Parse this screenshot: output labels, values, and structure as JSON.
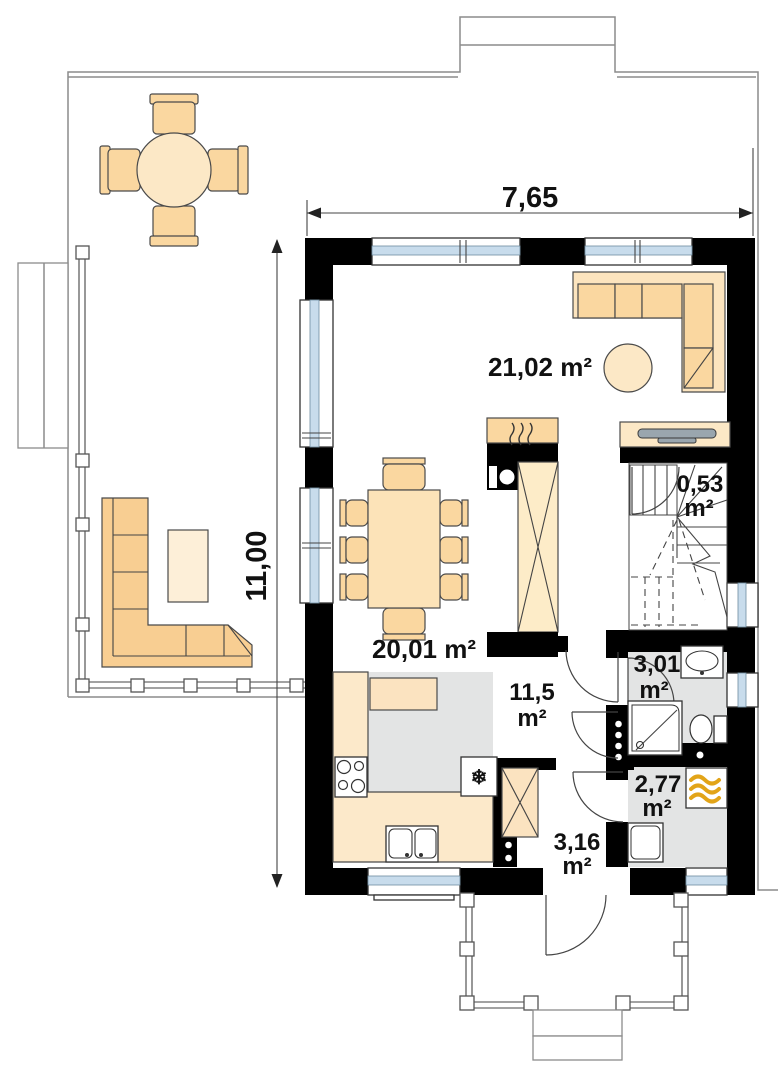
{
  "plan": {
    "dimension_labels": {
      "width": "7,65",
      "depth": "11,00"
    },
    "room_areas": {
      "living_room": "21,02 m²",
      "kitchen_dining": "20,01 m²",
      "hall_value": "11,5",
      "hall_unit": "m²",
      "stairs_storage_value": "0,53",
      "stairs_storage_unit": "m²",
      "bathroom_value": "3,01",
      "bathroom_unit": "m²",
      "utility_value": "2,77",
      "utility_unit": "m²",
      "vestibule_value": "3,16",
      "vestibule_unit": "m²"
    },
    "icons": {
      "fridge_snowflake": "❄"
    },
    "colors": {
      "wall_black": "#000000",
      "floor_gray": "#E3E4E4",
      "furniture_tan": "#FAD7A0",
      "furniture_cream": "#FCE8C6",
      "window_glass_blue": "#C8DCEC",
      "boiler_flame_yellow": "#E2A418",
      "tv_gray": "#9AA6AE",
      "outline_gray": "#8C8C8C"
    }
  }
}
